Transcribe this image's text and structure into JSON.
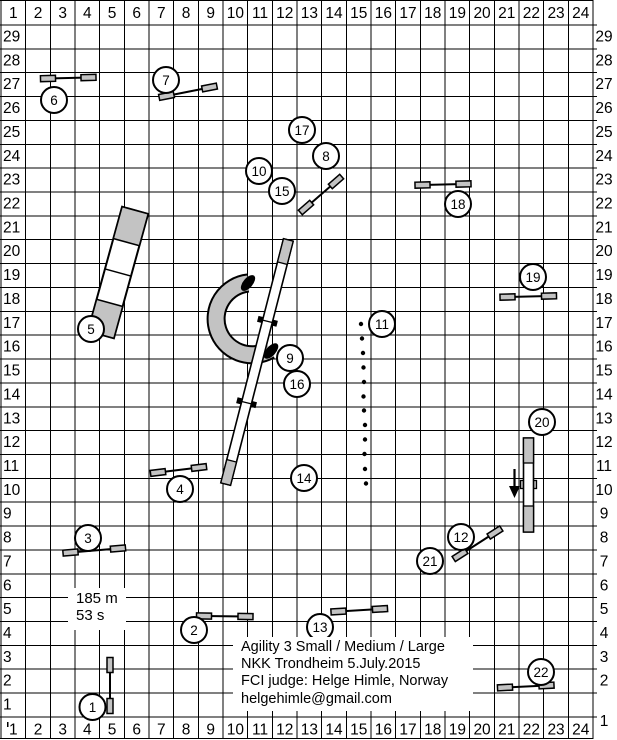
{
  "title_block": {
    "line1": "Agility 3 Small / Medium / Large",
    "line2": "NKK Trondheim 5.July.2015",
    "line3": "FCI judge: Helge Himle, Norway",
    "line4": "helgehimle@gmail.com"
  },
  "stats": {
    "distance": "185 m",
    "time": "53 s"
  },
  "colors": {
    "line": "#000000",
    "gray": "#c3c3c3",
    "white": "#ffffff",
    "text": "#000000"
  },
  "grid": {
    "cols": 24,
    "rows": 29,
    "x0": 1,
    "cell_w": 24.67,
    "band_h": 25,
    "cell_h": 23.86,
    "tick_right": 597,
    "col_labels": [
      "1",
      "2",
      "3",
      "4",
      "5",
      "6",
      "7",
      "8",
      "9",
      "10",
      "11",
      "12",
      "13",
      "14",
      "15",
      "16",
      "17",
      "18",
      "19",
      "20",
      "21",
      "22",
      "23",
      "24"
    ],
    "row_labels": [
      "29",
      "28",
      "27",
      "26",
      "25",
      "24",
      "23",
      "22",
      "21",
      "20",
      "19",
      "18",
      "17",
      "16",
      "15",
      "14",
      "13",
      "12",
      "11",
      "10",
      "9",
      "8",
      "7",
      "6",
      "5",
      "4",
      "3",
      "2",
      "1"
    ]
  },
  "obstacle_numbers": [
    {
      "n": "1",
      "x": 92.5,
      "y": 707
    },
    {
      "n": "2",
      "x": 194,
      "y": 630
    },
    {
      "n": "3",
      "x": 88,
      "y": 538
    },
    {
      "n": "4",
      "x": 180,
      "y": 489
    },
    {
      "n": "5",
      "x": 91,
      "y": 329
    },
    {
      "n": "6",
      "x": 54,
      "y": 100
    },
    {
      "n": "7",
      "x": 166,
      "y": 80
    },
    {
      "n": "8",
      "x": 326,
      "y": 156
    },
    {
      "n": "9",
      "x": 290,
      "y": 358
    },
    {
      "n": "10",
      "x": 259,
      "y": 171
    },
    {
      "n": "11",
      "x": 382,
      "y": 324
    },
    {
      "n": "12",
      "x": 461,
      "y": 537
    },
    {
      "n": "13",
      "x": 320,
      "y": 627
    },
    {
      "n": "14",
      "x": 304,
      "y": 478
    },
    {
      "n": "15",
      "x": 282,
      "y": 191
    },
    {
      "n": "16",
      "x": 297,
      "y": 384
    },
    {
      "n": "17",
      "x": 302,
      "y": 130
    },
    {
      "n": "18",
      "x": 458,
      "y": 204
    },
    {
      "n": "19",
      "x": 533,
      "y": 277
    },
    {
      "n": "20",
      "x": 542,
      "y": 422
    },
    {
      "n": "21",
      "x": 430,
      "y": 561
    },
    {
      "n": "22",
      "x": 541,
      "y": 672
    }
  ],
  "obstacles": {
    "jumps": [
      {
        "name": "jump-1",
        "x1": 110,
        "y1": 665,
        "x2": 110,
        "y2": 706
      },
      {
        "name": "jump-2",
        "x1": 204,
        "y1": 616,
        "x2": 245.5,
        "y2": 616.5
      },
      {
        "name": "jump-3",
        "x1": 70.5,
        "y1": 552.5,
        "x2": 118,
        "y2": 548.5
      },
      {
        "name": "jump-4",
        "x1": 158,
        "y1": 472.5,
        "x2": 199,
        "y2": 467.5
      },
      {
        "name": "jump-6",
        "x1": 48,
        "y1": 78.5,
        "x2": 88.5,
        "y2": 77.5
      },
      {
        "name": "jump-7",
        "x1": 166.5,
        "y1": 96,
        "x2": 209.5,
        "y2": 87.5
      },
      {
        "name": "jump-8-10-15-17",
        "x1": 306,
        "y1": 207.5,
        "x2": 336,
        "y2": 181.5
      },
      {
        "name": "jump-12-21",
        "x1": 460,
        "y1": 555,
        "x2": 495,
        "y2": 532.5
      },
      {
        "name": "jump-13",
        "x1": 338.5,
        "y1": 611.5,
        "x2": 380,
        "y2": 609
      },
      {
        "name": "jump-18",
        "x1": 422.5,
        "y1": 185,
        "x2": 463.5,
        "y2": 184
      },
      {
        "name": "jump-19",
        "x1": 507.5,
        "y1": 297,
        "x2": 549,
        "y2": 296
      },
      {
        "name": "jump-22",
        "x1": 505,
        "y1": 687.5,
        "x2": 546.5,
        "y2": 685.5
      }
    ],
    "wing": {
      "len": 15,
      "w": 6
    },
    "tunnel": {
      "name": "tunnel-9-16",
      "path": "M 248 283 A 36 36 0 1 0 270 350",
      "outer_w": 19,
      "inner_w": 15,
      "caps": [
        {
          "cx": 248,
          "cy": 283,
          "rx": 9.5,
          "ry": 4.8,
          "angle": -50
        },
        {
          "cx": 271,
          "cy": 351,
          "rx": 9.5,
          "ry": 4.8,
          "angle": -48
        }
      ]
    },
    "dogwalk": {
      "name": "dog-walk-14",
      "cx": 257,
      "cy": 362,
      "angle": 14.4,
      "w": 10,
      "len": 252,
      "contact_len": 24,
      "joint_fracs": [
        0.3333,
        0.6667
      ]
    },
    "aframe": {
      "name": "a-frame-5",
      "cx": 118,
      "cy": 272.5,
      "angle": 15.4,
      "w": 27,
      "len": 129,
      "contact_len": 33
    },
    "seesaw": {
      "name": "seesaw-20",
      "x": 523.5,
      "y": 438,
      "w": 10,
      "len": 94,
      "contact_len": 25,
      "pivot": {
        "x": 520.5,
        "y": 480.5,
        "w": 16,
        "h": 8
      },
      "arrow": {
        "x": 514.5,
        "y1": 469,
        "y2": 488,
        "head_w": 11,
        "tip_y": 498
      }
    },
    "weaves": {
      "name": "weave-poles-11",
      "dots": [
        [
          361,
          324
        ],
        [
          362,
          338.5
        ],
        [
          363,
          353
        ],
        [
          363.5,
          367.5
        ],
        [
          364,
          382
        ],
        [
          363.5,
          396.5
        ],
        [
          364,
          410.5
        ],
        [
          365,
          425
        ],
        [
          365,
          439.5
        ],
        [
          364.5,
          454
        ],
        [
          365,
          469
        ],
        [
          366,
          483.5
        ]
      ],
      "dot_r": 2.2
    },
    "circle_r": 13
  }
}
